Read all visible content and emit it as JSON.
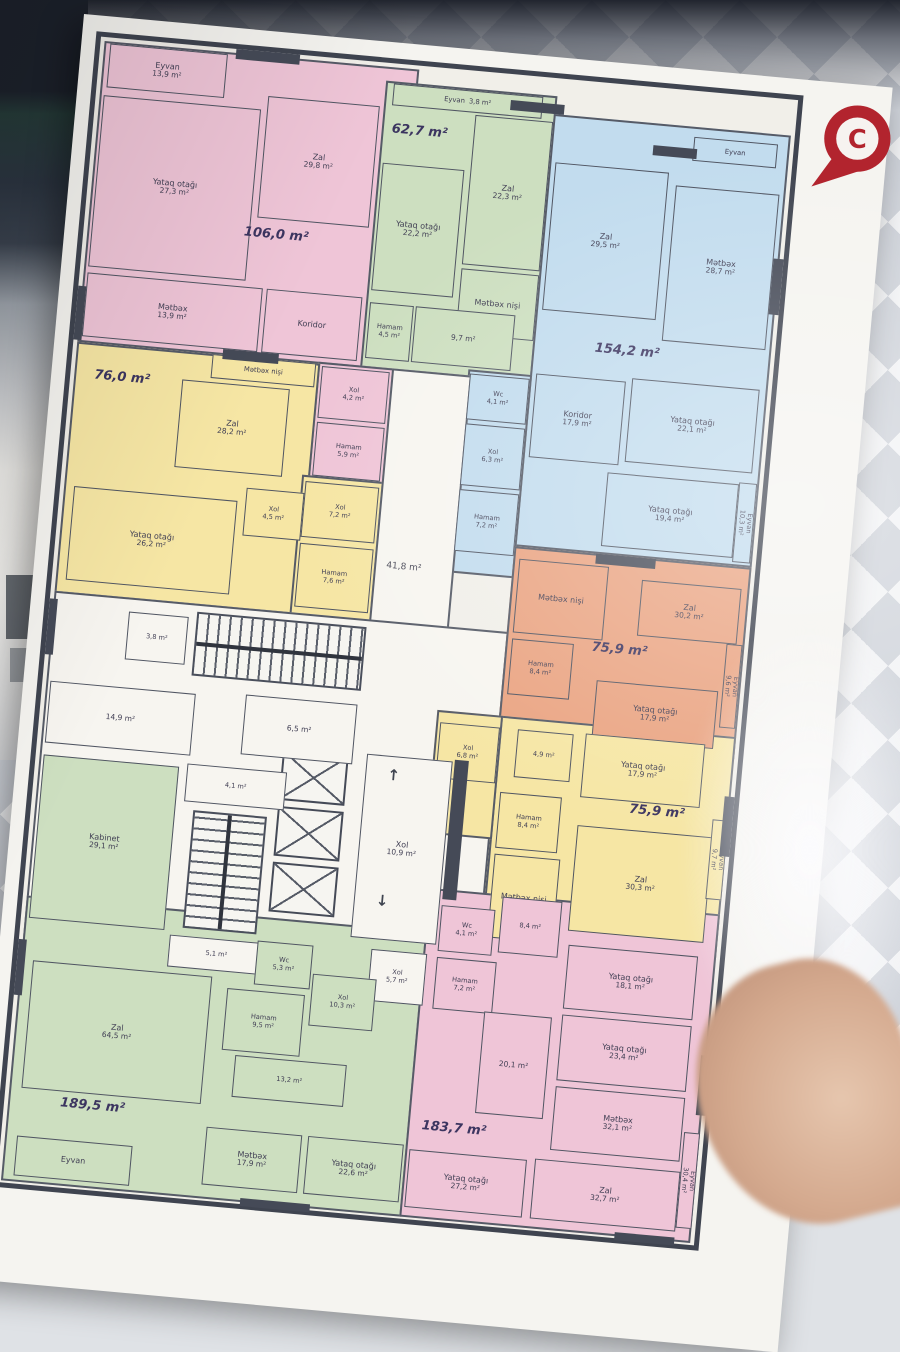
{
  "scene": {
    "marker_letter": "C"
  },
  "palette": {
    "pink": "#efc5d7",
    "green": "#cddfc0",
    "blue": "#c2dcee",
    "yellow": "#f6e6a4",
    "orange": "#eaa482",
    "core": "#f7f5f0",
    "wall": "#454a57",
    "marker": "#b2242e"
  },
  "plan": {
    "zones": [
      {
        "c": "pink",
        "x": 4,
        "y": 4,
        "w": 316,
        "h": 302
      },
      {
        "c": "green",
        "x": 288,
        "y": 18,
        "w": 172,
        "h": 288
      },
      {
        "c": "blue",
        "x": 458,
        "y": 36,
        "w": 238,
        "h": 434
      },
      {
        "c": "blue",
        "x": 396,
        "y": 298,
        "w": 64,
        "h": 204
      },
      {
        "c": "pink",
        "x": 246,
        "y": 304,
        "w": 76,
        "h": 118
      },
      {
        "c": "yellow",
        "x": 4,
        "y": 306,
        "w": 244,
        "h": 252
      },
      {
        "c": "yellow",
        "x": 240,
        "y": 418,
        "w": 82,
        "h": 144
      },
      {
        "c": "core",
        "x": 320,
        "y": 304,
        "w": 80,
        "h": 340
      },
      {
        "c": "core",
        "x": 4,
        "y": 556,
        "w": 456,
        "h": 350
      },
      {
        "c": "orange",
        "x": 458,
        "y": 470,
        "w": 238,
        "h": 192
      },
      {
        "c": "yellow",
        "x": 460,
        "y": 640,
        "w": 236,
        "h": 222
      },
      {
        "c": "yellow",
        "x": 396,
        "y": 640,
        "w": 66,
        "h": 124
      },
      {
        "c": "green",
        "x": 4,
        "y": 862,
        "w": 402,
        "h": 286
      },
      {
        "c": "pink",
        "x": 404,
        "y": 818,
        "w": 292,
        "h": 330
      }
    ],
    "rooms": [
      {
        "n": "Eyvan",
        "a": "13,9 m²",
        "c": "pink",
        "x": 10,
        "y": 6,
        "w": 118,
        "h": 44
      },
      {
        "n": "Yataq otağı",
        "a": "27,3 m²",
        "c": "pink",
        "x": 8,
        "y": 58,
        "w": 158,
        "h": 172
      },
      {
        "n": "Zal",
        "a": "29,8 m²",
        "c": "pink",
        "x": 172,
        "y": 44,
        "w": 112,
        "h": 122
      },
      {
        "n": "Mətbəx",
        "a": "13,9 m²",
        "c": "pink",
        "x": 8,
        "y": 236,
        "w": 176,
        "h": 64
      },
      {
        "n": "Koridor",
        "c": "pink",
        "x": 188,
        "y": 236,
        "w": 96,
        "h": 64
      },
      {
        "n": "Xol",
        "a": "4,2 m²",
        "c": "pink",
        "x": 250,
        "y": 308,
        "w": 68,
        "h": 52,
        "sm": 1
      },
      {
        "n": "Hamam",
        "a": "5,9 m²",
        "c": "pink",
        "x": 250,
        "y": 364,
        "w": 68,
        "h": 54,
        "sm": 1
      },
      {
        "n": "Eyvan",
        "a": "3,8 m²",
        "c": "green",
        "x": 296,
        "y": 20,
        "w": 150,
        "h": 22,
        "one": 1
      },
      {
        "n": "Yataq otağı",
        "a": "22,2 m²",
        "c": "green",
        "x": 292,
        "y": 100,
        "w": 82,
        "h": 128
      },
      {
        "n": "Zal",
        "a": "22,3 m²",
        "c": "green",
        "x": 380,
        "y": 44,
        "w": 78,
        "h": 150
      },
      {
        "n": "Mətbəx nişi",
        "c": "green",
        "x": 380,
        "y": 198,
        "w": 78,
        "h": 66
      },
      {
        "a": "9,7 m²",
        "c": "green",
        "x": 338,
        "y": 240,
        "w": 100,
        "h": 56
      },
      {
        "n": "Hamam",
        "a": "4,5 m²",
        "c": "green",
        "x": 292,
        "y": 240,
        "w": 44,
        "h": 56,
        "sm": 1
      },
      {
        "n": "Eyvan",
        "c": "blue",
        "x": 600,
        "y": 46,
        "w": 84,
        "h": 24,
        "one": 1
      },
      {
        "n": "Zal",
        "a": "29,5 m²",
        "c": "blue",
        "x": 464,
        "y": 84,
        "w": 114,
        "h": 148
      },
      {
        "n": "Mətbəx",
        "a": "28,7 m²",
        "c": "blue",
        "x": 586,
        "y": 96,
        "w": 104,
        "h": 156
      },
      {
        "n": "Koridor",
        "a": "17,9 m²",
        "c": "blue",
        "x": 464,
        "y": 296,
        "w": 90,
        "h": 84
      },
      {
        "n": "Yataq otağı",
        "a": "22,1 m²",
        "c": "blue",
        "x": 560,
        "y": 292,
        "w": 128,
        "h": 84
      },
      {
        "n": "Yataq otağı",
        "a": "19,4 m²",
        "c": "blue",
        "x": 544,
        "y": 388,
        "w": 132,
        "h": 74
      },
      {
        "n": "Eyvan",
        "a": "10,3 m²",
        "c": "blue",
        "x": 676,
        "y": 386,
        "w": 18,
        "h": 80,
        "v": 1
      },
      {
        "n": "Wc",
        "a": "4,1 m²",
        "c": "blue",
        "x": 398,
        "y": 302,
        "w": 60,
        "h": 46,
        "sm": 1
      },
      {
        "n": "Xol",
        "a": "6,3 m²",
        "c": "blue",
        "x": 398,
        "y": 352,
        "w": 60,
        "h": 62,
        "sm": 1
      },
      {
        "n": "Hamam",
        "a": "7,2 m²",
        "c": "blue",
        "x": 398,
        "y": 418,
        "w": 60,
        "h": 62,
        "sm": 1
      },
      {
        "n": "Mətbəx nişi",
        "c": "yellow",
        "x": 140,
        "y": 306,
        "w": 104,
        "h": 24,
        "one": 1
      },
      {
        "n": "Zal",
        "a": "28,2 m²",
        "c": "yellow",
        "x": 112,
        "y": 334,
        "w": 108,
        "h": 88
      },
      {
        "n": "Xol",
        "a": "4,5 m²",
        "c": "yellow",
        "x": 186,
        "y": 436,
        "w": 58,
        "h": 48,
        "sm": 1
      },
      {
        "n": "Yataq otağı",
        "a": "26,2 m²",
        "c": "yellow",
        "x": 14,
        "y": 450,
        "w": 164,
        "h": 94
      },
      {
        "n": "Xol",
        "a": "7,2 m²",
        "c": "yellow",
        "x": 244,
        "y": 424,
        "w": 74,
        "h": 56,
        "sm": 1
      },
      {
        "n": "Hamam",
        "a": "7,6 m²",
        "c": "yellow",
        "x": 244,
        "y": 486,
        "w": 74,
        "h": 64,
        "sm": 1
      },
      {
        "n": "Mətbəx nişi",
        "c": "orange",
        "x": 464,
        "y": 482,
        "w": 90,
        "h": 74
      },
      {
        "n": "Hamam",
        "a": "8,4 m²",
        "c": "orange",
        "x": 464,
        "y": 562,
        "w": 62,
        "h": 56,
        "sm": 1
      },
      {
        "n": "Zal",
        "a": "30,2 m²",
        "c": "orange",
        "x": 588,
        "y": 492,
        "w": 100,
        "h": 56
      },
      {
        "n": "Eyvan",
        "a": "9,6 m²",
        "c": "orange",
        "x": 678,
        "y": 548,
        "w": 16,
        "h": 84,
        "v": 1
      },
      {
        "n": "Yataq otağı",
        "a": "17,9 m²",
        "c": "orange",
        "x": 552,
        "y": 596,
        "w": 122,
        "h": 58
      },
      {
        "n": "Xol",
        "a": "6,8 m²",
        "c": "yellow",
        "x": 400,
        "y": 652,
        "w": 60,
        "h": 56,
        "sm": 1
      },
      {
        "a": "4,9 m²",
        "c": "yellow",
        "x": 478,
        "y": 652,
        "w": 56,
        "h": 48,
        "sm": 1
      },
      {
        "n": "Yataq otağı",
        "a": "17,9 m²",
        "c": "yellow",
        "x": 546,
        "y": 650,
        "w": 120,
        "h": 64
      },
      {
        "n": "Hamam",
        "a": "8,4 m²",
        "c": "yellow",
        "x": 466,
        "y": 716,
        "w": 62,
        "h": 56,
        "sm": 1
      },
      {
        "n": "Mətbəx nişi",
        "c": "yellow",
        "x": 466,
        "y": 778,
        "w": 66,
        "h": 84
      },
      {
        "n": "Zal",
        "a": "30,3 m²",
        "c": "yellow",
        "x": 546,
        "y": 742,
        "w": 136,
        "h": 106
      },
      {
        "n": "Eyvan",
        "a": "9,7 m²",
        "c": "yellow",
        "x": 680,
        "y": 724,
        "w": 16,
        "h": 80,
        "v": 1
      },
      {
        "a": "3,8 m²",
        "c": "core",
        "x": 80,
        "y": 570,
        "w": 60,
        "h": 48,
        "sm": 1
      },
      {
        "a": "14,9 m²",
        "c": "core",
        "x": 8,
        "y": 646,
        "w": 146,
        "h": 62
      },
      {
        "a": "6,5 m²",
        "c": "core",
        "x": 204,
        "y": 642,
        "w": 112,
        "h": 60
      },
      {
        "a": "4,1 m²",
        "c": "core",
        "x": 152,
        "y": 716,
        "w": 100,
        "h": 38,
        "sm": 1
      },
      {
        "n": "Kabinet",
        "a": "29,1 m²",
        "c": "green",
        "x": 8,
        "y": 720,
        "w": 136,
        "h": 164
      },
      {
        "a": "5,1 m²",
        "c": "core",
        "x": 150,
        "y": 888,
        "w": 96,
        "h": 32,
        "sm": 1
      },
      {
        "n": "Xol",
        "a": "10,9 m²",
        "c": "core",
        "x": 330,
        "y": 690,
        "w": 86,
        "h": 184
      },
      {
        "n": "Wc",
        "a": "5,3 m²",
        "c": "green",
        "x": 238,
        "y": 886,
        "w": 56,
        "h": 44,
        "sm": 1
      },
      {
        "n": "Xol",
        "a": "5,7 m²",
        "c": "core",
        "x": 352,
        "y": 884,
        "w": 56,
        "h": 52,
        "sm": 1
      },
      {
        "n": "Hamam",
        "a": "9,5 m²",
        "c": "green",
        "x": 212,
        "y": 936,
        "w": 78,
        "h": 62,
        "sm": 1
      },
      {
        "n": "Xol",
        "a": "10,3 m²",
        "c": "green",
        "x": 296,
        "y": 914,
        "w": 64,
        "h": 52,
        "sm": 1
      },
      {
        "a": "13,2 m²",
        "c": "green",
        "x": 226,
        "y": 1002,
        "w": 112,
        "h": 42,
        "sm": 1
      },
      {
        "n": "Zal",
        "a": "64,5 m²",
        "c": "green",
        "x": 16,
        "y": 926,
        "w": 180,
        "h": 128
      },
      {
        "n": "Mətbəx",
        "a": "17,9 m²",
        "c": "green",
        "x": 204,
        "y": 1076,
        "w": 96,
        "h": 58
      },
      {
        "n": "Yataq otağı",
        "a": "22,6 m²",
        "c": "green",
        "x": 306,
        "y": 1076,
        "w": 96,
        "h": 58
      },
      {
        "n": "Eyvan",
        "c": "green",
        "x": 16,
        "y": 1102,
        "w": 116,
        "h": 40
      },
      {
        "n": "Wc",
        "a": "4,1 m²",
        "c": "pink",
        "x": 418,
        "y": 834,
        "w": 54,
        "h": 46,
        "sm": 1
      },
      {
        "a": "8,4 m²",
        "c": "pink",
        "x": 478,
        "y": 820,
        "w": 60,
        "h": 56,
        "sm": 1
      },
      {
        "n": "Hamam",
        "a": "7,2 m²",
        "c": "pink",
        "x": 418,
        "y": 886,
        "w": 60,
        "h": 52,
        "sm": 1
      },
      {
        "n": "Yataq otağı",
        "a": "18,1 m²",
        "c": "pink",
        "x": 548,
        "y": 862,
        "w": 130,
        "h": 64
      },
      {
        "n": "Yataq otağı",
        "a": "23,4 m²",
        "c": "pink",
        "x": 548,
        "y": 932,
        "w": 130,
        "h": 66
      },
      {
        "a": "20,1 m²",
        "c": "pink",
        "x": 470,
        "y": 936,
        "w": 68,
        "h": 102
      },
      {
        "n": "Mətbəx",
        "a": "32,1 m²",
        "c": "pink",
        "x": 548,
        "y": 1004,
        "w": 130,
        "h": 64
      },
      {
        "n": "Yataq otağı",
        "a": "27,2 m²",
        "c": "pink",
        "x": 408,
        "y": 1080,
        "w": 118,
        "h": 58
      },
      {
        "n": "Zal",
        "a": "32,7 m²",
        "c": "pink",
        "x": 534,
        "y": 1078,
        "w": 146,
        "h": 60
      },
      {
        "n": "Eyvan",
        "a": "30,4 m²",
        "c": "pink",
        "x": 680,
        "y": 1038,
        "w": 16,
        "h": 96,
        "v": 1
      }
    ],
    "totals": [
      {
        "t": "106,0 m²",
        "x": 160,
        "y": 174
      },
      {
        "t": "62,7 m²",
        "x": 298,
        "y": 58
      },
      {
        "t": "154,2 m²",
        "x": 520,
        "y": 258
      },
      {
        "t": "76,0 m²",
        "x": 24,
        "y": 330
      },
      {
        "t": "75,9 m²",
        "x": 544,
        "y": 556
      },
      {
        "t": "75,9 m²",
        "x": 596,
        "y": 714
      },
      {
        "t": "189,5 m²",
        "x": 56,
        "y": 1058
      },
      {
        "t": "183,7 m²",
        "x": 418,
        "y": 1048
      },
      {
        "t": "41,8 m²",
        "x": 332,
        "y": 496,
        "small": 1
      }
    ],
    "features": {
      "stairs": [
        {
          "x": 148,
          "y": 564,
          "w": 170,
          "h": 64,
          "dir": "h"
        },
        {
          "x": 162,
          "y": 762,
          "w": 74,
          "h": 118,
          "dir": "v"
        }
      ],
      "lifts": [
        {
          "x": 246,
          "y": 694,
          "w": 66,
          "h": 50
        },
        {
          "x": 246,
          "y": 750,
          "w": 66,
          "h": 50
        },
        {
          "x": 246,
          "y": 806,
          "w": 66,
          "h": 50
        }
      ],
      "blocks": [
        {
          "x": 136,
          "y": 0,
          "w": 64,
          "h": 10
        },
        {
          "x": 414,
          "y": 26,
          "w": 54,
          "h": 10
        },
        {
          "x": 560,
          "y": 58,
          "w": 44,
          "h": 10
        },
        {
          "x": 690,
          "y": 160,
          "w": 10,
          "h": 56
        },
        {
          "x": 0,
          "y": 250,
          "w": 8,
          "h": 54
        },
        {
          "x": 150,
          "y": 300,
          "w": 56,
          "h": 10
        },
        {
          "x": 0,
          "y": 564,
          "w": 8,
          "h": 56
        },
        {
          "x": 540,
          "y": 470,
          "w": 60,
          "h": 10
        },
        {
          "x": 418,
          "y": 688,
          "w": 14,
          "h": 140
        },
        {
          "x": 690,
          "y": 700,
          "w": 10,
          "h": 60
        },
        {
          "x": 0,
          "y": 906,
          "w": 8,
          "h": 56
        },
        {
          "x": 690,
          "y": 960,
          "w": 10,
          "h": 60
        },
        {
          "x": 244,
          "y": 1144,
          "w": 70,
          "h": 8
        },
        {
          "x": 620,
          "y": 1144,
          "w": 60,
          "h": 8
        }
      ],
      "arrows": [
        {
          "x": 352,
          "y": 700,
          "ch": "↑"
        },
        {
          "x": 352,
          "y": 826,
          "ch": "↓"
        }
      ]
    }
  }
}
